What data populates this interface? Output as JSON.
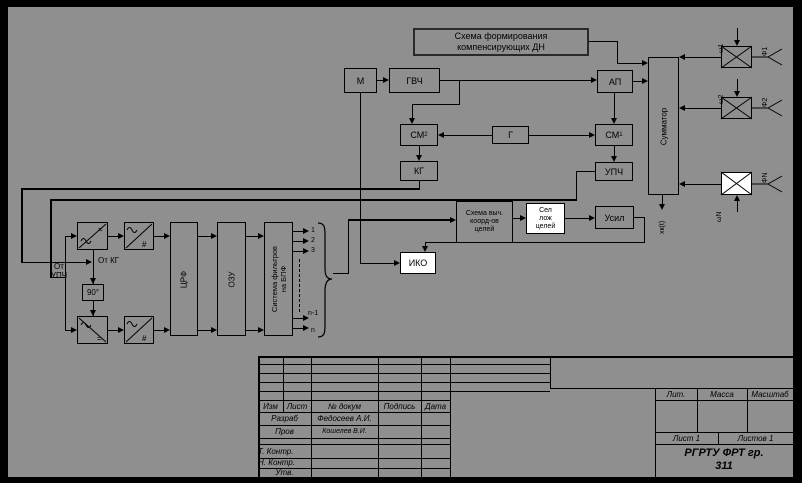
{
  "diagram": {
    "title_box": [
      "Схема формирования",
      "компенсирующих ДН"
    ],
    "blocks": {
      "m": "М",
      "gvch": "ГВЧ",
      "ap": "АП",
      "sm2": "СМ",
      "sm2_sub": "2",
      "g": "Г",
      "sm1": "СМ",
      "sm1_sub": "1",
      "kg": "КГ",
      "upch": "УПЧ",
      "summator": "Сумматор",
      "phase90": "90°",
      "crf": "ЦРФ",
      "ozu": "ОЗУ",
      "filterbank_l1": "Система фильтров",
      "filterbank_l2": "на БПФ",
      "calc_l1": "Схема выч.",
      "calc_l2": "коорд-ов",
      "calc_l3": "целей",
      "sel_l1": "Сел",
      "sel_l2": "лож",
      "sel_l3": "целей",
      "usil": "Усил",
      "iko": "ИКО"
    },
    "symbols": {
      "dc": "=",
      "digital": "#"
    },
    "labels": {
      "ot_kg": "От КГ",
      "ot_upch": "От УПЧ",
      "sum_out": "xк(t)",
      "w1": "ω1",
      "w2": "ω2",
      "w3": "ωN",
      "ant1": "Ф1",
      "ant2": "Ф2",
      "ant3": "ФN",
      "out1": "1",
      "out2": "2",
      "out3": "3",
      "out4": "n-1",
      "out5": "n"
    }
  },
  "title_block": {
    "col_izm": "Изм",
    "col_list": "Лист",
    "col_docum": "№ докум",
    "col_podpis": "Подпись",
    "col_data": "Дата",
    "razrab": "Разраб",
    "razrab_name": "Федосеев А.И.",
    "prov": "Пров",
    "prov_name": "Кошелев В.И.",
    "t_kontr": "Т. Контр.",
    "n_kontr": "Н. Контр.",
    "utv": "Утв.",
    "lit": "Лит.",
    "massa": "Масса",
    "masshtab": "Масштаб",
    "list": "Лист 1",
    "listov": "Листов 1",
    "org1": "РГРТУ  ФРТ гр.",
    "org2": "311"
  },
  "colors": {
    "background": "#000000",
    "panel": "#8f8f8f",
    "line": "#000000",
    "white_box": "#ffffff"
  }
}
